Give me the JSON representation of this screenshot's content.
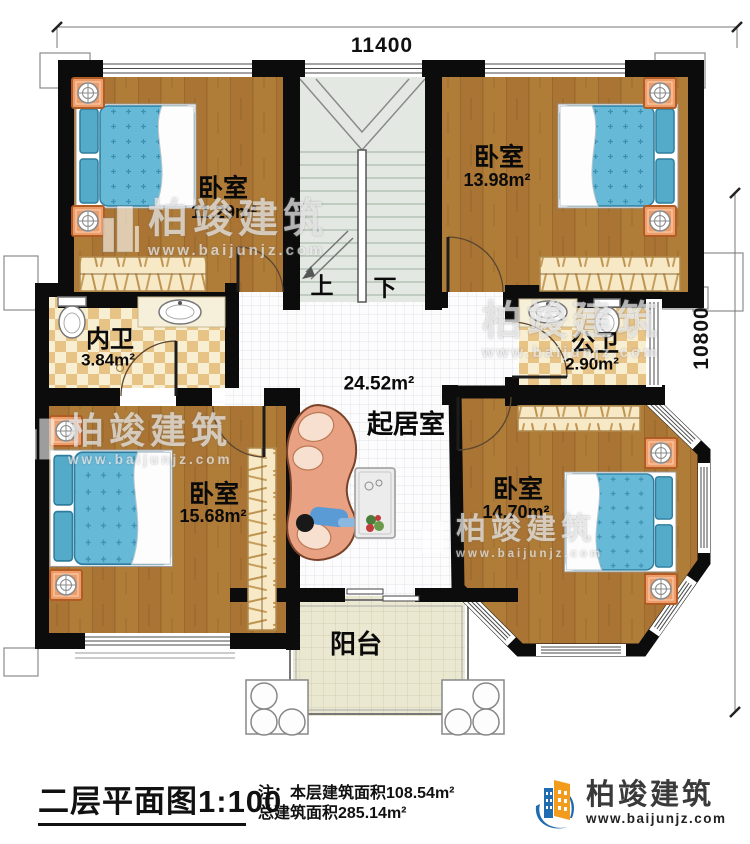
{
  "plan": {
    "dimensions": {
      "width_mm": "11400",
      "height_mm": "10800"
    },
    "stairs": {
      "up": "上",
      "down": "下"
    },
    "rooms": [
      {
        "name": "卧室",
        "area": "11.29m²"
      },
      {
        "name": "卧室",
        "area": "13.98m²"
      },
      {
        "name": "内卫",
        "area": "3.84m²"
      },
      {
        "name": "公卫",
        "area": "2.90m²"
      },
      {
        "name": "起居室",
        "area": "24.52m²"
      },
      {
        "name": "卧室",
        "area": "15.68m²"
      },
      {
        "name": "卧室",
        "area": "14.70m²"
      },
      {
        "name": "阳台",
        "area": ""
      }
    ]
  },
  "watermark": {
    "name": "柏竣建筑",
    "url": "www.baijunjz.com"
  },
  "footer": {
    "title": "二层平面图1:100",
    "note_prefix": "注：",
    "note_line1": "本层建筑面积108.54m²",
    "note_line2": "总建筑面积285.14m²",
    "brand_name": "柏竣建筑",
    "brand_url": "www.baijunjz.com"
  },
  "colors": {
    "wall": "#0c0c0c",
    "wood": "#b07d38",
    "bed_blue": "#64b6d6",
    "brand_blue": "#1f6cb0",
    "brand_orange": "#f29b1d"
  }
}
